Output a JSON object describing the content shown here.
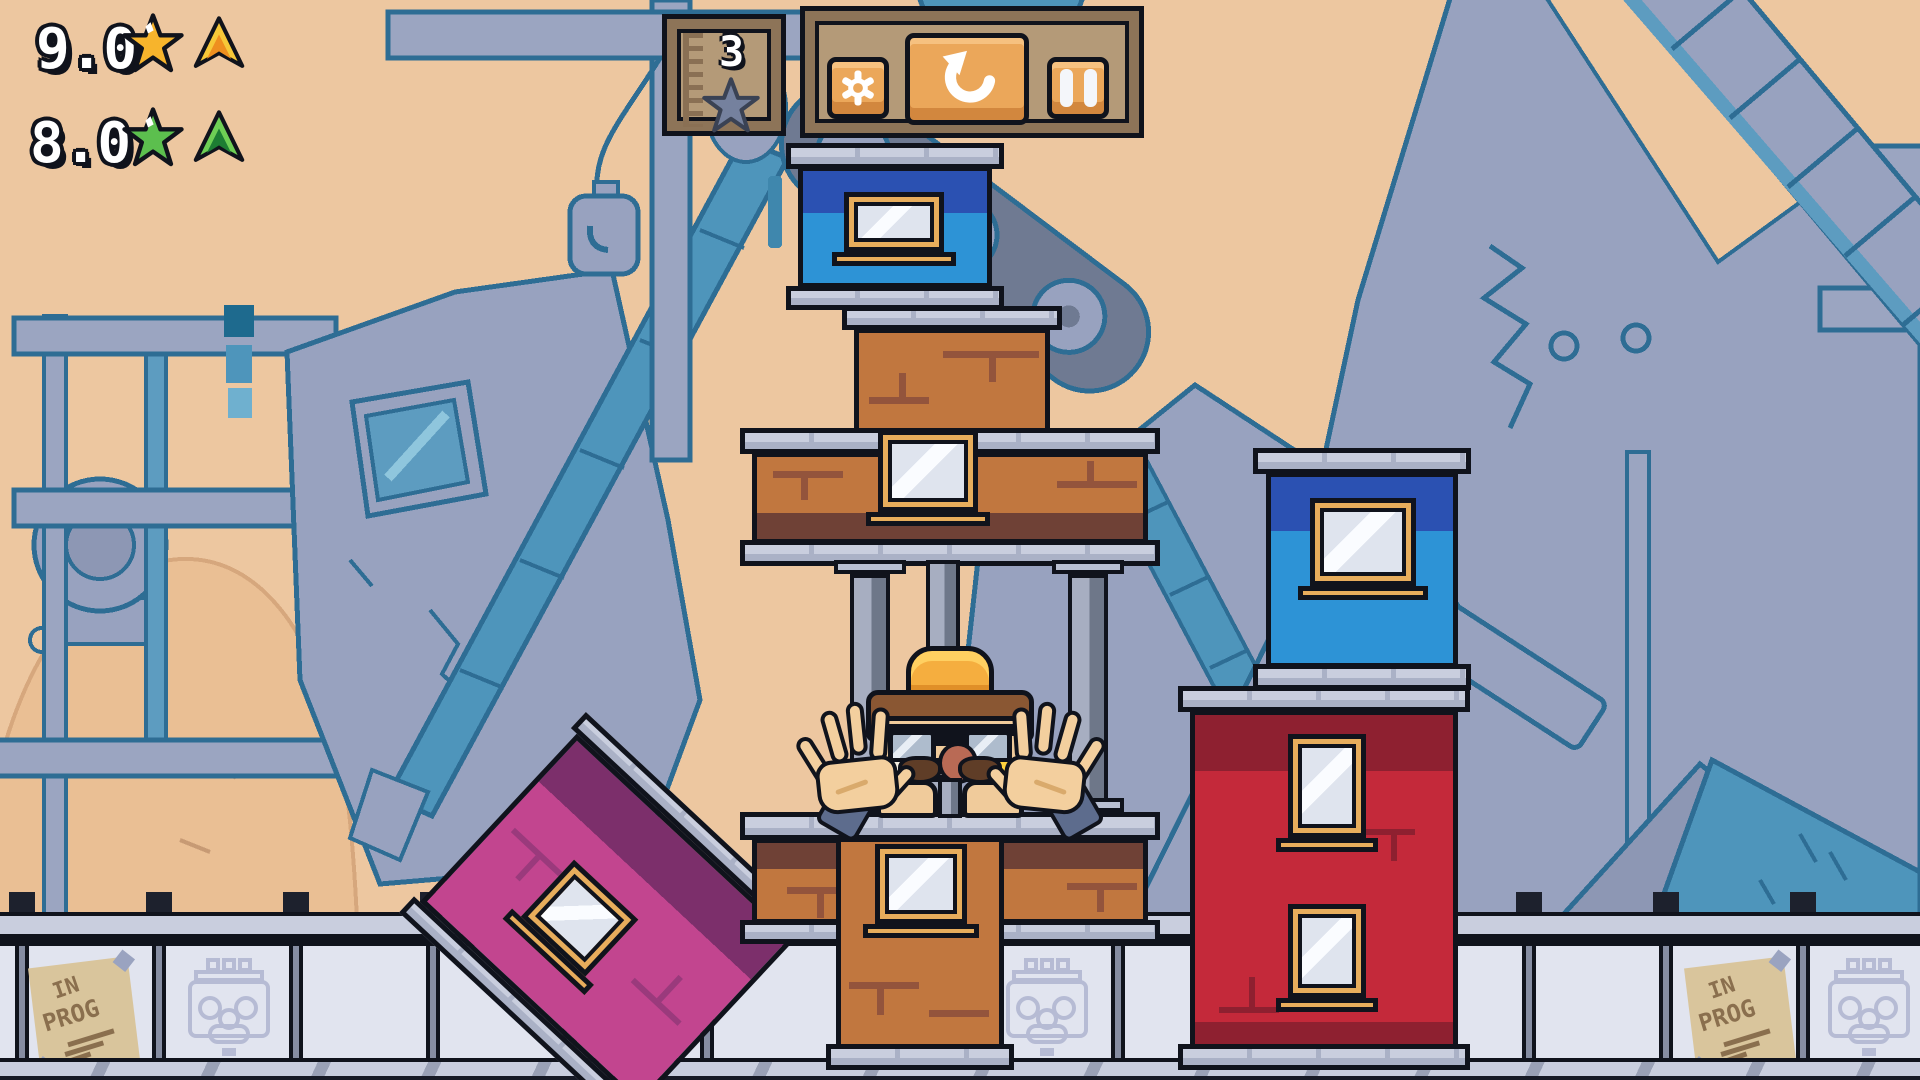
{
  "hud": {
    "scores": [
      {
        "id": "gold",
        "value": "9.0",
        "star_icon": "star-gold-icon",
        "arrow_icon": "arrow-up-gold-icon",
        "color": "#f7b42c"
      },
      {
        "id": "green",
        "value": "8.0",
        "star_icon": "star-green-icon",
        "arrow_icon": "arrow-up-green-icon",
        "color": "#5cbf4e"
      }
    ],
    "height_gauge": {
      "value": "3",
      "icon": "star-gray-icon"
    },
    "controls": [
      {
        "id": "settings",
        "icon": "gear-icon"
      },
      {
        "id": "restart",
        "icon": "restart-icon"
      },
      {
        "id": "pause",
        "icon": "pause-icon"
      }
    ]
  },
  "fence": {
    "poster": {
      "line1": "IN",
      "line2": "PROG"
    },
    "stencil_icon": "worker-face-stencil-icon"
  },
  "palette": {
    "sky": "#edc7a0",
    "background_structures": "#98a2bf",
    "background_outline": "#2e6d94",
    "background_accent": "#4e95bb",
    "brick_block": "#c1773f",
    "brick_block_dark": "#6f4136",
    "blue_block": "#2d93d6",
    "blue_block_dark": "#2b51b2",
    "red_block": "#c4293a",
    "red_block_dark": "#8e2030",
    "purple_block": "#c2458f",
    "purple_block_dark": "#7c2f6b",
    "window_frame": "#e7ad5c",
    "slab": "#c9cede",
    "outline": "#10131c",
    "hud_panel": "#b49a78",
    "hud_panel_frame": "#8d7458",
    "hud_button": "#eba75a"
  }
}
